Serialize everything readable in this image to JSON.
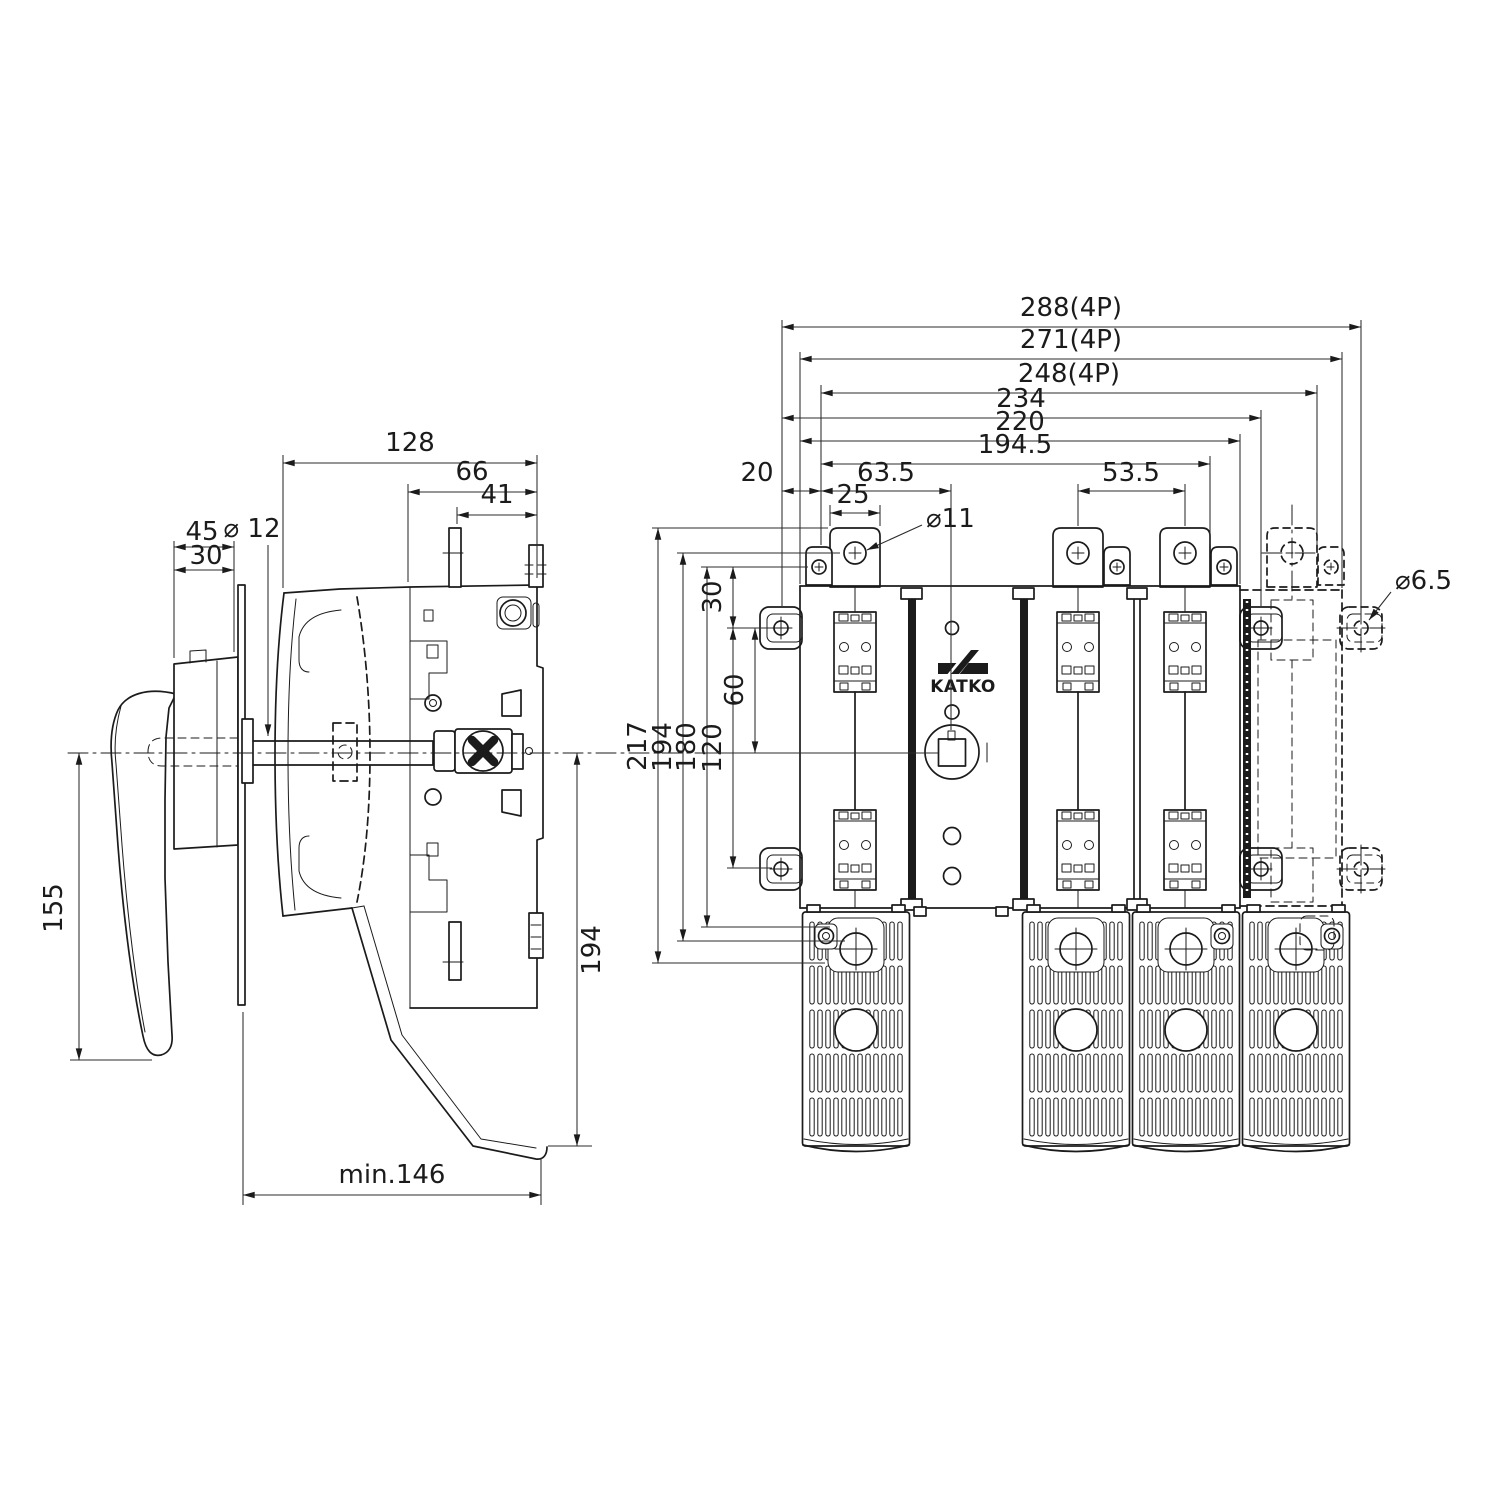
{
  "logo": {
    "brand": "KATKO"
  },
  "dims": {
    "side": {
      "w128": "128",
      "w66": "66",
      "w41": "41",
      "d45": "45",
      "d30": "30",
      "dia12": "⌀ 12",
      "h155": "155",
      "h194": "194",
      "min146": "min.146"
    },
    "front": {
      "w288": "288(4P)",
      "w271": "271(4P)",
      "w248": "248(4P)",
      "w234": "234",
      "w220": "220",
      "w194_5": "194.5",
      "w20": "20",
      "w63_5": "63.5",
      "w25": "25",
      "w53_5": "53.5",
      "dia11": "⌀11",
      "dia6_5": "⌀6.5",
      "v30": "30",
      "v60": "60",
      "v120": "120",
      "v180": "180",
      "v194": "194",
      "v217": "217"
    }
  }
}
